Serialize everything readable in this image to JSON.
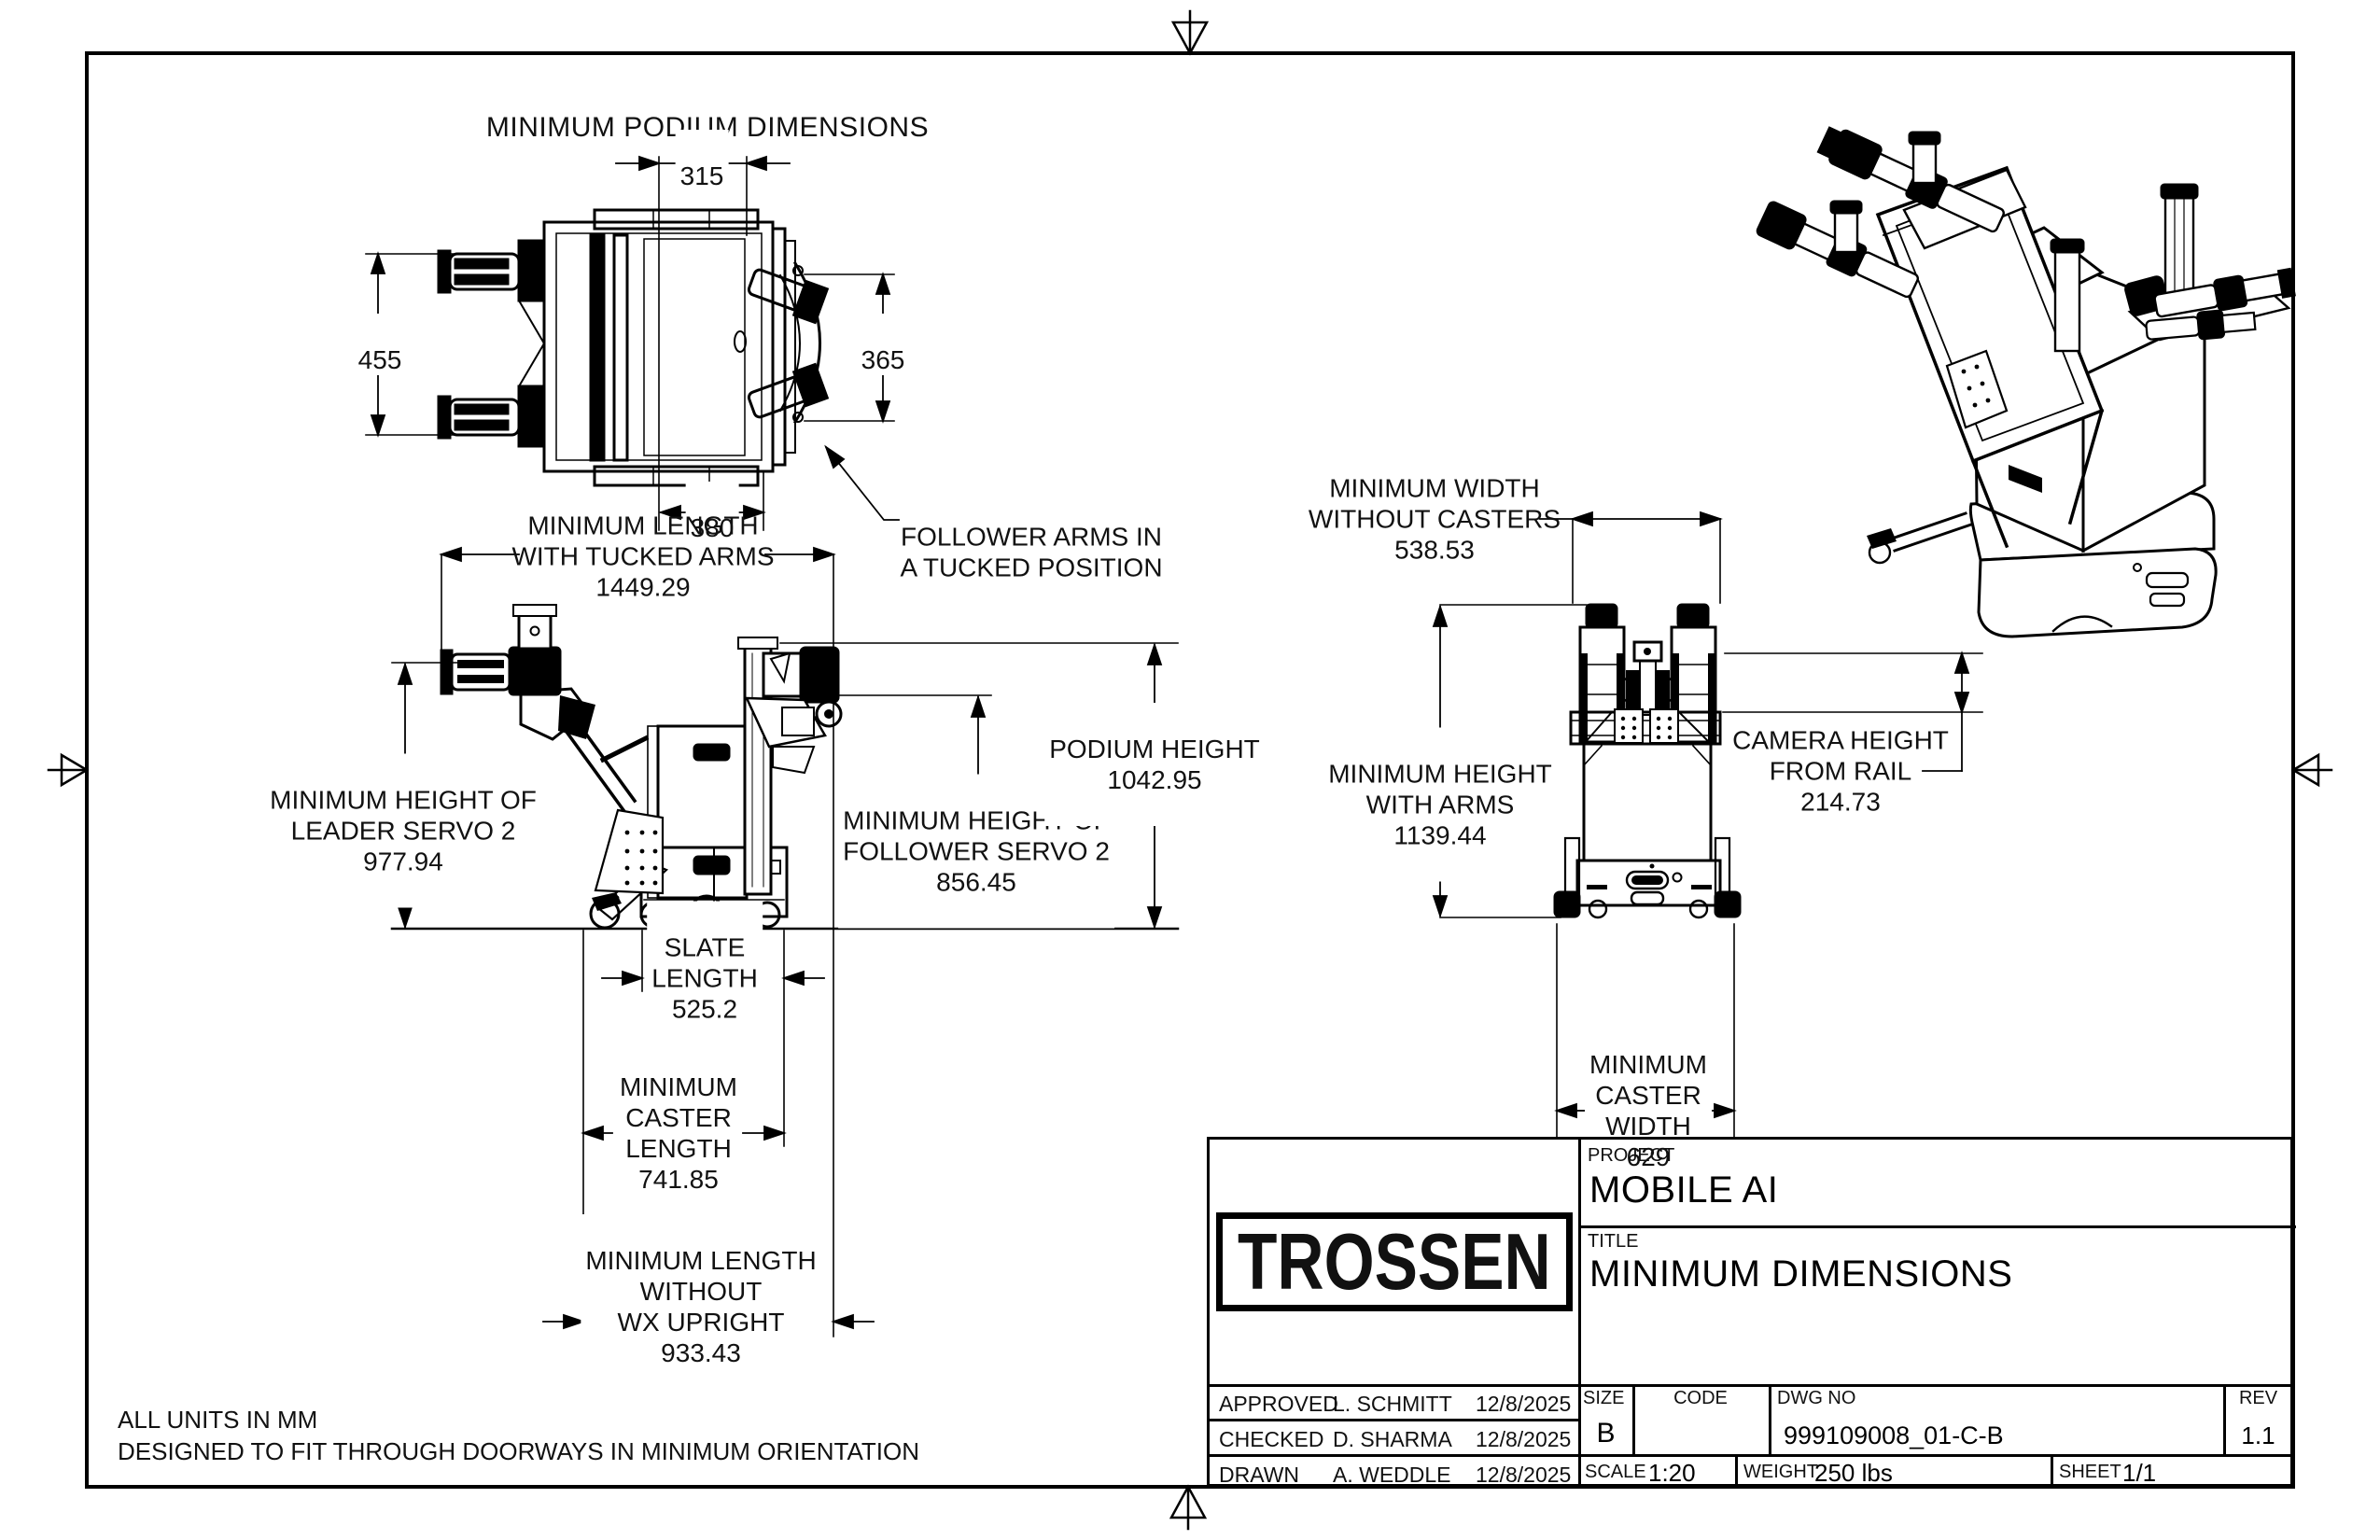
{
  "sheet": {
    "notes": {
      "line1": "ALL UNITS IN MM",
      "line2": "DESIGNED TO FIT THROUGH DOORWAYS IN MINIMUM ORIENTATION"
    }
  },
  "top_view": {
    "title": "MINIMUM PODIUM DIMENSIONS",
    "dim_width_top": "315",
    "dim_height_left": "455",
    "dim_height_right": "365",
    "dim_width_bottom": "380",
    "note": "FOLLOWER ARMS IN\nA TUCKED POSITION"
  },
  "side_view": {
    "length_tucked": {
      "label": "MINIMUM LENGTH\nWITH TUCKED ARMS",
      "value": "1449.29"
    },
    "leader_height": {
      "label": "MINIMUM HEIGHT OF\nLEADER SERVO 2",
      "value": "977.94"
    },
    "follower_height": {
      "label": "MINIMUM HEIGHT OF\nFOLLOWER SERVO 2",
      "value": "856.45"
    },
    "podium_height": {
      "label": "PODIUM HEIGHT",
      "value": "1042.95"
    },
    "slate_length": {
      "label": "SLATE\nLENGTH",
      "value": "525.2"
    },
    "caster_length": {
      "label": "MINIMUM\nCASTER\nLENGTH",
      "value": "741.85"
    },
    "length_without_upright": {
      "label": "MINIMUM LENGTH\nWITHOUT\nWX UPRIGHT",
      "value": "933.43"
    }
  },
  "front_view": {
    "width_without_casters": {
      "label": "MINIMUM WIDTH\nWITHOUT CASTERS",
      "value": "538.53"
    },
    "height_with_arms": {
      "label": "MINIMUM HEIGHT\nWITH ARMS",
      "value": "1139.44"
    },
    "camera_height": {
      "label": "CAMERA HEIGHT\nFROM RAIL",
      "value": "214.73"
    },
    "caster_width": {
      "label": "MINIMUM\nCASTER\nWIDTH",
      "value": "629"
    }
  },
  "title_block": {
    "logo": "TROSSEN",
    "project_label": "PROJECT",
    "project_name": "MOBILE AI",
    "title_label": "TITLE",
    "drawing_title": "MINIMUM DIMENSIONS",
    "approvals": [
      {
        "role": "APPROVED",
        "name": "L. SCHMITT",
        "date": "12/8/2025"
      },
      {
        "role": "CHECKED",
        "name": "D. SHARMA",
        "date": "12/8/2025"
      },
      {
        "role": "DRAWN",
        "name": "A. WEDDLE",
        "date": "12/8/2025"
      }
    ],
    "size_label": "SIZE",
    "size": "B",
    "code_label": "CODE",
    "code": "",
    "dwg_label": "DWG NO",
    "dwg_no": "999109008_01-C-B",
    "rev_label": "REV",
    "rev": "1.1",
    "scale_label": "SCALE",
    "scale": "1:20",
    "weight_label": "WEIGHT",
    "weight": "250 lbs",
    "sheet_label": "SHEET",
    "sheet": "1/1"
  }
}
